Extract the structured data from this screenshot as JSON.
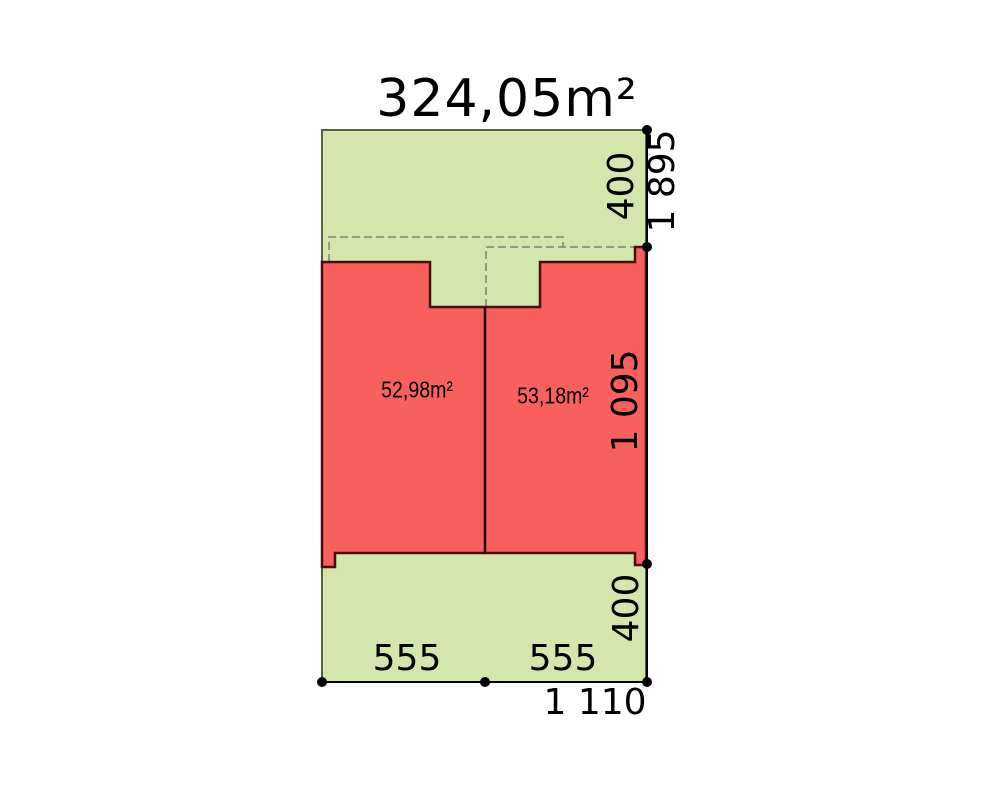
{
  "title": "324,05m²",
  "units": {
    "left_area": "52,98m²",
    "right_area": "53,18m²"
  },
  "dims": {
    "top_strip": "400",
    "total_height": "1 895",
    "building_height": "1 095",
    "bottom_strip": "400",
    "bottom_left_width": "555",
    "bottom_right_width": "555",
    "total_width": "1 110"
  },
  "colors": {
    "background": "#ffffff",
    "plot_fill": "#d3e7ac",
    "plot_stroke": "#55613f",
    "building_fill": "#f7605c",
    "building_stroke": "#4a0d0d",
    "divider_stroke": "#200404",
    "dashed_stroke": "#7d8471",
    "dimension_black": "#000000"
  }
}
